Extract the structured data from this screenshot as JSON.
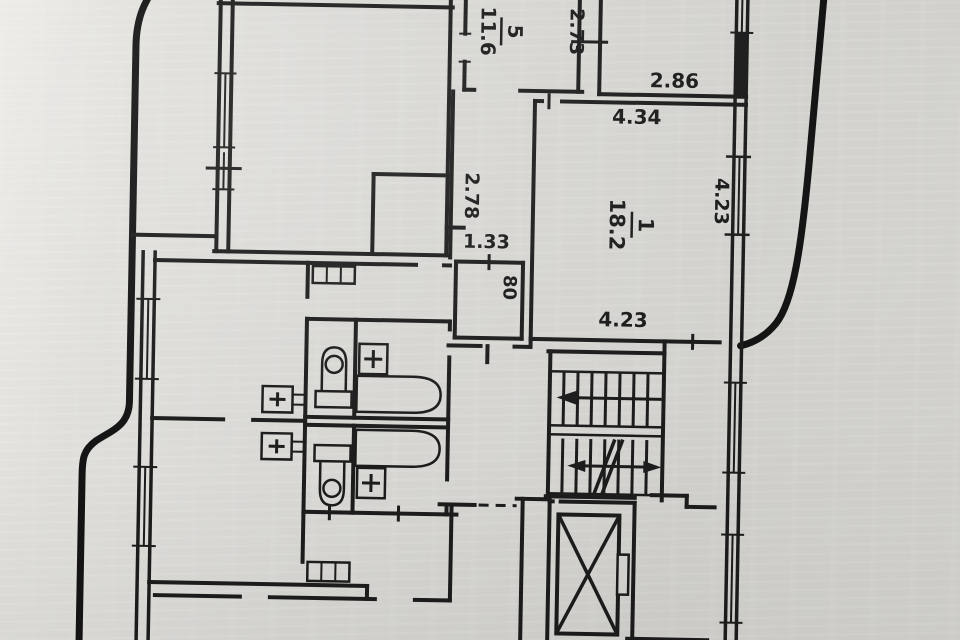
{
  "plan": {
    "rooms": {
      "room5": {
        "number": "5",
        "area": "11.6"
      },
      "room1": {
        "number": "1",
        "area": "18.2"
      }
    },
    "dimensions": {
      "top_shaft_width": "2.73",
      "top_right_width": "2.86",
      "room1_top_width": "4.34",
      "room1_right_height": "4.23",
      "room1_bottom_width": "4.23",
      "corridor_height": "2.78",
      "hall_width": "1.33",
      "closet_width": "80"
    },
    "colors": {
      "ink": "#1b1b1b",
      "thick_ink": "#141414",
      "paper": "#d7d6d2"
    }
  }
}
